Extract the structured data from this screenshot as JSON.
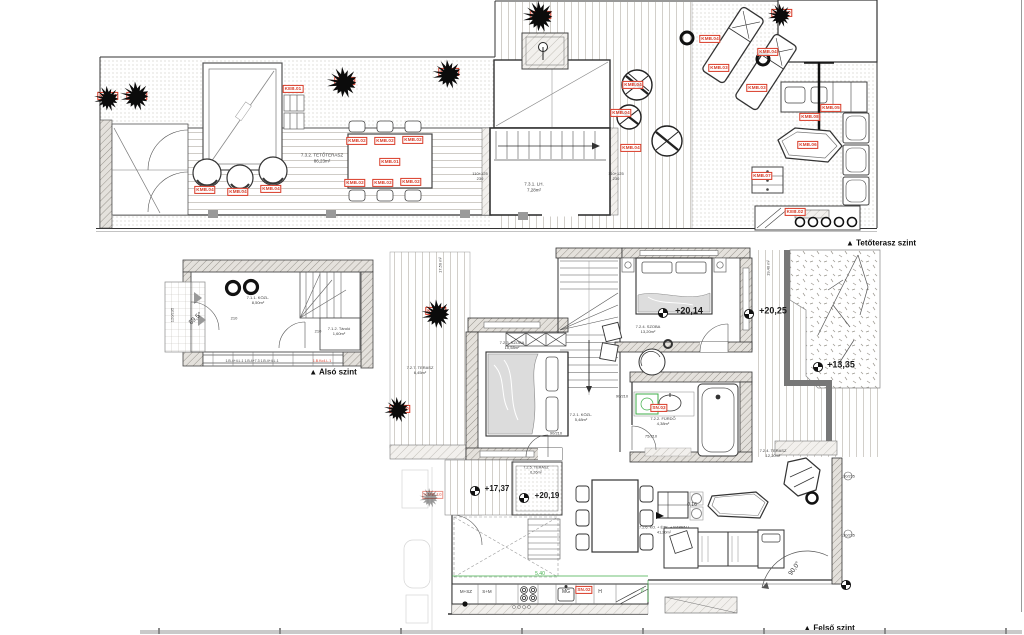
{
  "levels": {
    "roof": "▲ Tetőterasz  szint",
    "lower": "▲ Alsó szint",
    "upper": "▲ Felső szint"
  },
  "colors": {
    "accent_red": "#d83a26",
    "dim_green": "#3fae49",
    "ink": "#333333"
  },
  "red_labels": [
    {
      "t": "KMB.10",
      "x": 108,
      "y": 96
    },
    {
      "t": "KMB.10",
      "x": 137,
      "y": 96
    },
    {
      "t": "KMB.10",
      "x": 345,
      "y": 81
    },
    {
      "t": "KMB.10",
      "x": 449,
      "y": 72
    },
    {
      "t": "KMB.10",
      "x": 541,
      "y": 15
    },
    {
      "t": "KMB.10",
      "x": 782,
      "y": 13
    },
    {
      "t": "KEB.01",
      "x": 293,
      "y": 89
    },
    {
      "t": "KMB.01",
      "x": 390,
      "y": 162
    },
    {
      "t": "KMB.02",
      "x": 357,
      "y": 141
    },
    {
      "t": "KMB.02",
      "x": 385,
      "y": 141
    },
    {
      "t": "KMB.02",
      "x": 413,
      "y": 140
    },
    {
      "t": "KMB.02",
      "x": 355,
      "y": 183
    },
    {
      "t": "KMB.02",
      "x": 383,
      "y": 183
    },
    {
      "t": "KMB.02",
      "x": 411,
      "y": 182
    },
    {
      "t": "KMB.04",
      "x": 205,
      "y": 190
    },
    {
      "t": "KMB.04",
      "x": 238,
      "y": 192
    },
    {
      "t": "KMB.04",
      "x": 271,
      "y": 189
    },
    {
      "t": "KMB.04",
      "x": 633,
      "y": 85
    },
    {
      "t": "KMB.04",
      "x": 621,
      "y": 113
    },
    {
      "t": "KMB.04",
      "x": 631,
      "y": 148
    },
    {
      "t": "KMB.04",
      "x": 710,
      "y": 39
    },
    {
      "t": "KMB.04",
      "x": 768,
      "y": 52
    },
    {
      "t": "KMB.03",
      "x": 719,
      "y": 68
    },
    {
      "t": "KMB.03",
      "x": 757,
      "y": 88
    },
    {
      "t": "KMB.05",
      "x": 831,
      "y": 108
    },
    {
      "t": "KMB.08",
      "x": 810,
      "y": 117
    },
    {
      "t": "KMB.06",
      "x": 808,
      "y": 145
    },
    {
      "t": "KMB.07",
      "x": 762,
      "y": 176
    },
    {
      "t": "KEB.02",
      "x": 795,
      "y": 212
    },
    {
      "t": "KMB.10",
      "x": 436,
      "y": 311
    },
    {
      "t": "KMB.10",
      "x": 400,
      "y": 409
    },
    {
      "t": "KMB.10",
      "x": 433,
      "y": 495,
      "o": 0.55
    },
    {
      "t": "SN.03",
      "x": 659,
      "y": 408
    },
    {
      "t": "SN.02",
      "x": 584,
      "y": 590
    }
  ],
  "annotations": [
    {
      "t": "7.3.2. TETŐTERASZ\n86,23m²",
      "x": 322,
      "y": 158,
      "s": 4.5
    },
    {
      "t": "7.3.1. LH.\n7,28m²",
      "x": 534,
      "y": 187,
      "s": 4.5
    },
    {
      "t": "110+125\n230",
      "x": 480,
      "y": 176,
      "s": 4
    },
    {
      "t": "110+125\n230",
      "x": 616,
      "y": 176,
      "s": 4
    },
    {
      "t": "7.1.1. KÖZL.\n8,50m²",
      "x": 258,
      "y": 300,
      "s": 4
    },
    {
      "t": "7.1.2. Tároló\n1,60m²",
      "x": 339,
      "y": 331,
      "s": 4
    },
    {
      "t": "89,5°",
      "x": 196,
      "y": 319,
      "s": 6.5,
      "r": -42
    },
    {
      "t": "210",
      "x": 234,
      "y": 318,
      "s": 4
    },
    {
      "t": "210",
      "x": 318,
      "y": 331,
      "s": 4
    },
    {
      "t": "120/235",
      "x": 172,
      "y": 315,
      "s": 4,
      "r": -90
    },
    {
      "t": "1.B.4+4.L.1   1.B.4+7.3   1.B.4+4.L.1",
      "x": 252,
      "y": 361,
      "s": 3.5
    },
    {
      "t": "1.B.Ko4.L.1",
      "x": 322,
      "y": 361,
      "s": 3.5,
      "c": "red"
    },
    {
      "t": "7.2.7. TERASZ\n6,45m²",
      "x": 420,
      "y": 370,
      "s": 4
    },
    {
      "t": "17,50 m²",
      "x": 440,
      "y": 265,
      "s": 4,
      "r": -90
    },
    {
      "t": "19,40 m²",
      "x": 768,
      "y": 268,
      "s": 4,
      "r": -90
    },
    {
      "t": "7.2.3. SZOBA\n10,58m²",
      "x": 512,
      "y": 345,
      "s": 4
    },
    {
      "t": "7.2.4. SZOBA\n13,20m²",
      "x": 648,
      "y": 329,
      "s": 4
    },
    {
      "t": "7.2.1. KÖZL.\n5,48m²",
      "x": 581,
      "y": 417,
      "s": 4
    },
    {
      "t": "7.2.2. FÜRDŐ\n4,38m²",
      "x": 663,
      "y": 421,
      "s": 4
    },
    {
      "t": "7.2.4. TERASZ\n12,20m²",
      "x": 773,
      "y": 453,
      "s": 4
    },
    {
      "t": "7.2.5. TERASZ\n6,26m²",
      "x": 536,
      "y": 470,
      "s": 3.8
    },
    {
      "t": "7.2.6. KO. + ÉTK. + NAPPALI\n41,20m²",
      "x": 664,
      "y": 530,
      "s": 3.8
    },
    {
      "t": "+20,14",
      "x": 689,
      "y": 311,
      "s": 9,
      "b": true
    },
    {
      "t": "+20,25",
      "x": 773,
      "y": 311,
      "s": 9,
      "b": true
    },
    {
      "t": "+13,35",
      "x": 841,
      "y": 365,
      "s": 9,
      "b": true
    },
    {
      "t": "+17,37",
      "x": 497,
      "y": 489,
      "s": 8,
      "b": true
    },
    {
      "t": "+20,19",
      "x": 547,
      "y": 496,
      "s": 8,
      "b": true
    },
    {
      "t": "90/210",
      "x": 556,
      "y": 433,
      "s": 4
    },
    {
      "t": "90/210",
      "x": 622,
      "y": 396,
      "s": 4
    },
    {
      "t": "75/210",
      "x": 651,
      "y": 436,
      "s": 4
    },
    {
      "t": "0,16",
      "x": 692,
      "y": 505,
      "s": 5
    },
    {
      "t": "130/235",
      "x": 848,
      "y": 477,
      "s": 3.8
    },
    {
      "t": "130/235",
      "x": 848,
      "y": 536,
      "s": 3.8
    },
    {
      "t": "5,40",
      "x": 540,
      "y": 574,
      "s": 5,
      "c": "green"
    },
    {
      "t": "60",
      "x": 642,
      "y": 590,
      "s": 4,
      "c": "green",
      "r": -90
    },
    {
      "t": "M+SZ",
      "x": 466,
      "y": 592,
      "s": 4.5
    },
    {
      "t": "S+M",
      "x": 487,
      "y": 592,
      "s": 4.5
    },
    {
      "t": "MG",
      "x": 566,
      "y": 592,
      "s": 5
    },
    {
      "t": "H",
      "x": 600,
      "y": 592,
      "s": 5
    },
    {
      "t": "90,0°",
      "x": 795,
      "y": 569,
      "s": 6.5,
      "r": -55
    }
  ],
  "markers": [
    {
      "x": 663,
      "y": 313
    },
    {
      "x": 749,
      "y": 314
    },
    {
      "x": 818,
      "y": 367
    },
    {
      "x": 475,
      "y": 491
    },
    {
      "x": 524,
      "y": 498
    },
    {
      "x": 846,
      "y": 585
    }
  ],
  "trees": [
    {
      "x": 108,
      "y": 99,
      "r": 13
    },
    {
      "x": 136,
      "y": 96,
      "r": 15
    },
    {
      "x": 344,
      "y": 83,
      "r": 16
    },
    {
      "x": 448,
      "y": 74,
      "r": 15
    },
    {
      "x": 540,
      "y": 17,
      "r": 16
    },
    {
      "x": 781,
      "y": 16,
      "r": 12
    },
    {
      "x": 437,
      "y": 314,
      "r": 15
    },
    {
      "x": 398,
      "y": 410,
      "r": 13
    },
    {
      "x": 430,
      "y": 498,
      "r": 10,
      "o": 0.4
    }
  ]
}
